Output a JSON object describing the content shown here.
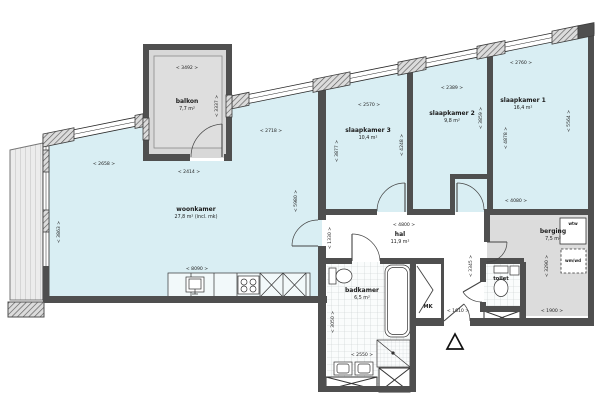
{
  "plan": {
    "type": "apartment-floorplan",
    "colors": {
      "room_fill": "#d9eef3",
      "outdoor_fill": "#dcdcdc",
      "wall": "#4f4f4f",
      "hal_fill": "#ffffff"
    },
    "icons": {
      "north_arrow": "triangle-up",
      "shaft": "crossed-box",
      "door": "quarter-arc"
    }
  },
  "rooms": {
    "balkon": {
      "name": "balkon",
      "area": "7,7 m²"
    },
    "woonkamer": {
      "name": "woonkamer",
      "area": "27,8 m² (incl. mk)"
    },
    "slaapkamer3": {
      "name": "slaapkamer 3",
      "area": "10,4 m²"
    },
    "slaapkamer2": {
      "name": "slaapkamer 2",
      "area": "9,8 m²"
    },
    "slaapkamer1": {
      "name": "slaapkamer 1",
      "area": "16,4 m²"
    },
    "hal": {
      "name": "hal",
      "area": "11,9 m²"
    },
    "badkamer": {
      "name": "badkamer",
      "area": "6,5 m²"
    },
    "toilet": {
      "name": "toilet"
    },
    "berging": {
      "name": "berging",
      "area": "7,5 m²"
    },
    "meterkast": {
      "name": "MK"
    }
  },
  "fixtures": {
    "wtw_label": "wtw",
    "wmwd_label": "wm/wd"
  },
  "dimensions_mm": {
    "balkon_width_top": "< 3492 >",
    "balkon_depth_right": "< 3337 >",
    "balkon_width_bottom": "< 2414 >",
    "woonkamer_top_left": "< 2658 >",
    "woonkamer_top_right": "< 2718 >",
    "woonkamer_left": "< 3863 >",
    "woonkamer_bottom": "< 8090 >",
    "woonkamer_right": "< 5980 >",
    "sk3_width": "< 2570 >",
    "sk3_left": "< 3877 >",
    "sk3_right": "< 4248 >",
    "sk2_width": "< 2389 >",
    "sk2_right": "< 3859 >",
    "sk1_width": "< 2760 >",
    "sk1_left": "< 4878 >",
    "sk1_right": "< 5564 >",
    "sk1_bottom": "< 4080 >",
    "hal_width": "< 4800 >",
    "hal_left": "< 1330 >",
    "hal_right": "< 3345 >",
    "hal_corridor": "< 1610 >",
    "badkamer_width": "< 2550 >",
    "badkamer_left": "< 3050 >",
    "berging_right": "< 3290 >",
    "berging_bottom": "< 1900 >"
  }
}
